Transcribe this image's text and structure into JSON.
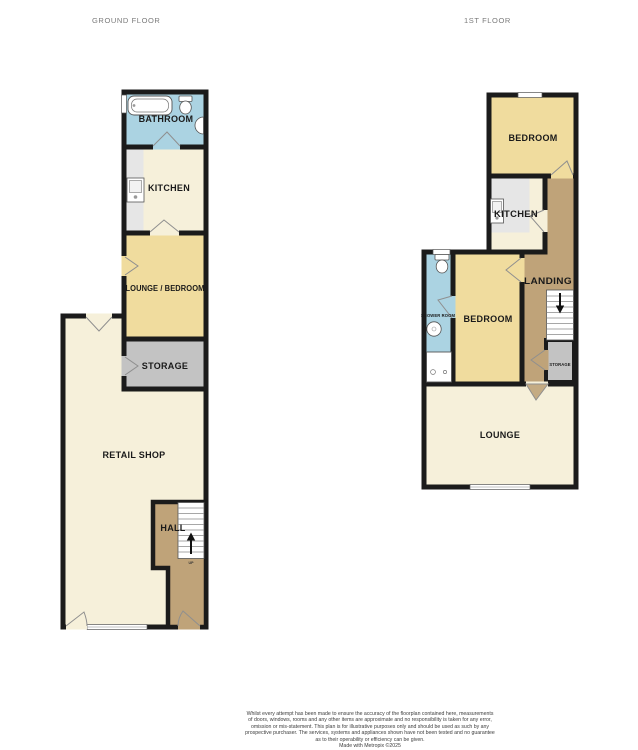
{
  "titles": {
    "ground": "GROUND FLOOR",
    "first": "1ST FLOOR"
  },
  "ground_floor": {
    "bathroom": "BATHROOM",
    "kitchen": "KITCHEN",
    "lounge_bedroom": "LOUNGE / BEDROOM",
    "storage": "STORAGE",
    "retail_shop": "RETAIL SHOP",
    "hall": "HALL",
    "stairs_direction": "UP"
  },
  "first_floor": {
    "bedroom_top": "BEDROOM",
    "kitchen": "KITCHEN",
    "landing": "LANDING",
    "shower_room": "SHOWER ROOM",
    "bedroom": "BEDROOM",
    "storage": "STORAGE",
    "lounge": "LOUNGE"
  },
  "colors": {
    "wall": "#1b1b1b",
    "bathroom_blue": "#abd3e2",
    "cream": "#f6f0da",
    "bedroom_yellow": "#f0dc9e",
    "storage_gray": "#c3c3c3",
    "hall_brown": "#bfa379",
    "counter_gray": "#e6e6e6",
    "fixture_white": "#ffffff",
    "title_gray": "#7a7a7a"
  },
  "disclaimer": {
    "lines": [
      "Whilst every attempt has been made to ensure the accuracy of the floorplan contained here, measurements",
      "of doors, windows, rooms and any other items are approximate and no responsibility is taken for any error,",
      "omission or mis-statement. This plan is for illustrative purposes only and should be used as such by any",
      "prospective purchaser. The services, systems and appliances shown have not been tested and no guarantee",
      "as to their operability or efficiency can be given.",
      "Made with Metropix ©2025"
    ]
  }
}
